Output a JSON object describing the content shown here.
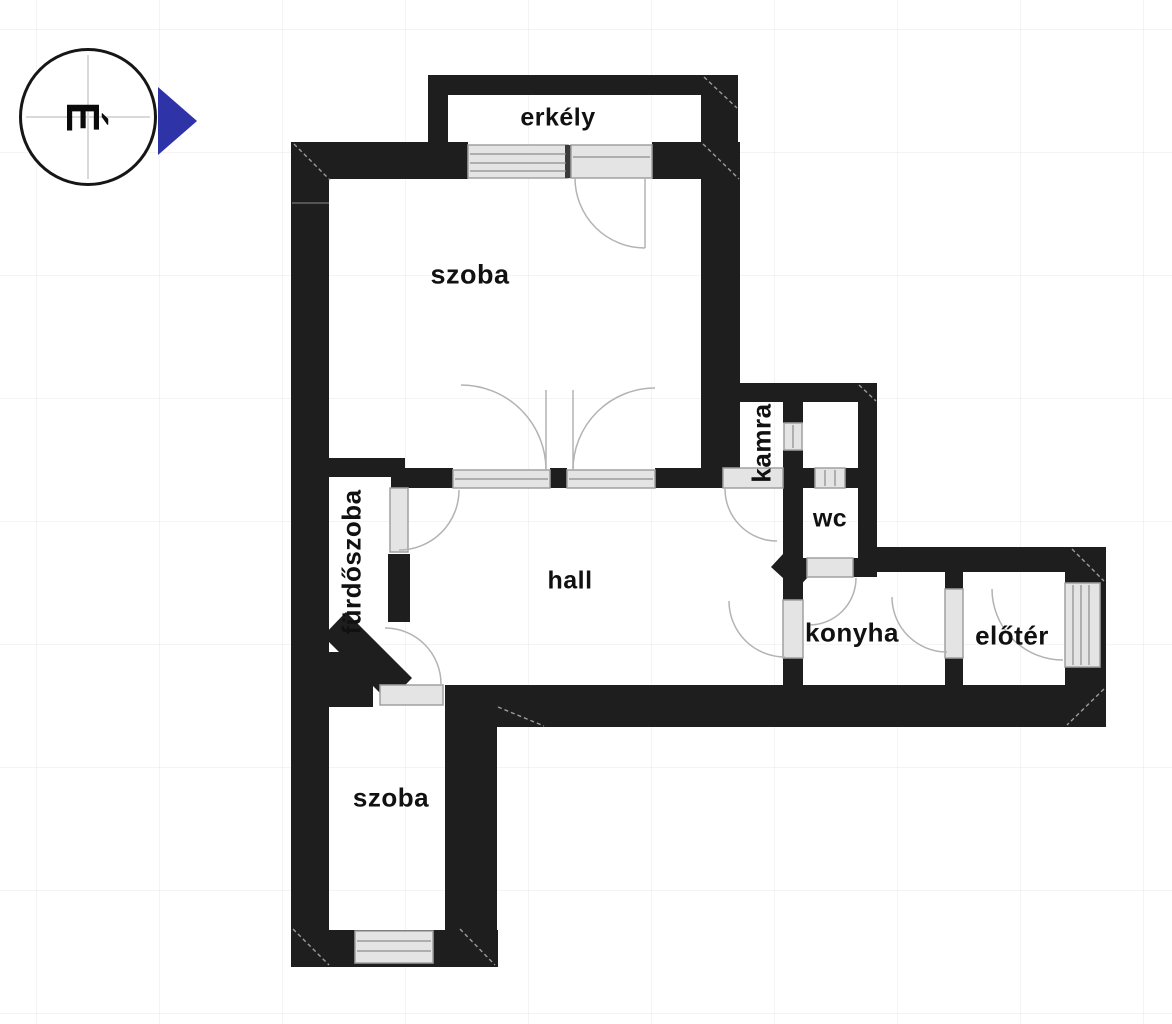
{
  "title": "apartment-floor-plan",
  "compass": {
    "letter": "É"
  },
  "rooms": [
    {
      "id": "erkely",
      "label": "erkély"
    },
    {
      "id": "szoba-top",
      "label": "szoba"
    },
    {
      "id": "kamra",
      "label": "kamra"
    },
    {
      "id": "wc",
      "label": "wc"
    },
    {
      "id": "hall",
      "label": "hall"
    },
    {
      "id": "konyha",
      "label": "konyha"
    },
    {
      "id": "eloter",
      "label": "előtér"
    },
    {
      "id": "furdoszoba",
      "label": "fürdőszoba"
    },
    {
      "id": "szoba-bottom",
      "label": "szoba"
    }
  ],
  "colors": {
    "wall": "#1e1e1e",
    "frame_fill": "#e4e4e4",
    "frame_border": "#a0a0a0",
    "arc": "#b3b3b3",
    "north_arrow": "#2e34a8"
  }
}
